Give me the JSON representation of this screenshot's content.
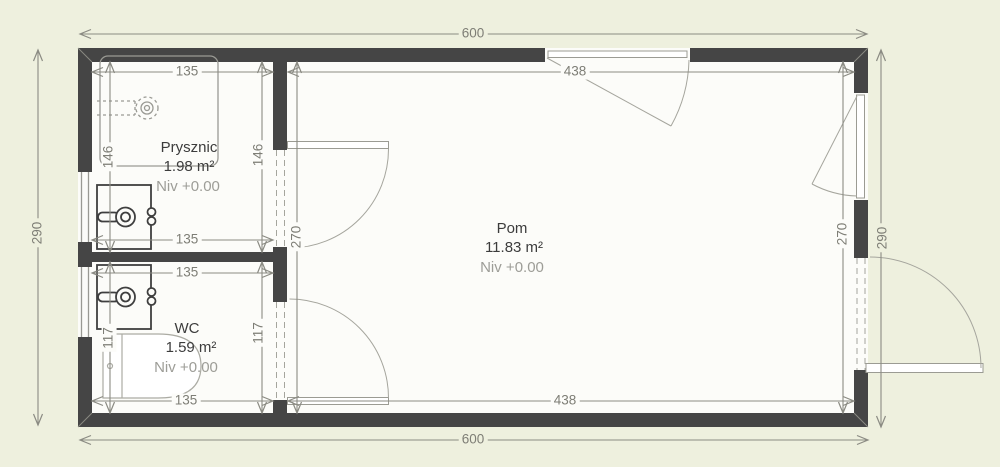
{
  "colors": {
    "bg": "#eef0de",
    "floor": "#fcfcf9",
    "wall": "#454545",
    "dim": "#8b8b83",
    "fixture": "#9a9a94",
    "dark": "#3f3f3f",
    "dimtext": "#7e7e76",
    "textdark": "#3c3c3c",
    "textlight": "#9d9d97",
    "doorline": "#9b9b93"
  },
  "rooms": {
    "prysznic": {
      "name": "Prysznic",
      "area": "1.98 m²",
      "level": "Niv +0.00"
    },
    "wc": {
      "name": "WC",
      "area": "1.59 m²",
      "level": "Niv +0.00"
    },
    "pom": {
      "name": "Pom",
      "area": "11.83 m²",
      "level": "Niv +0.00"
    }
  },
  "dimensions": {
    "overall_width": "600",
    "overall_depth": "290",
    "pom_width": "438",
    "pom_depth": "270",
    "bath_width": "135",
    "prysznic_depth": "146",
    "wc_depth": "117"
  }
}
